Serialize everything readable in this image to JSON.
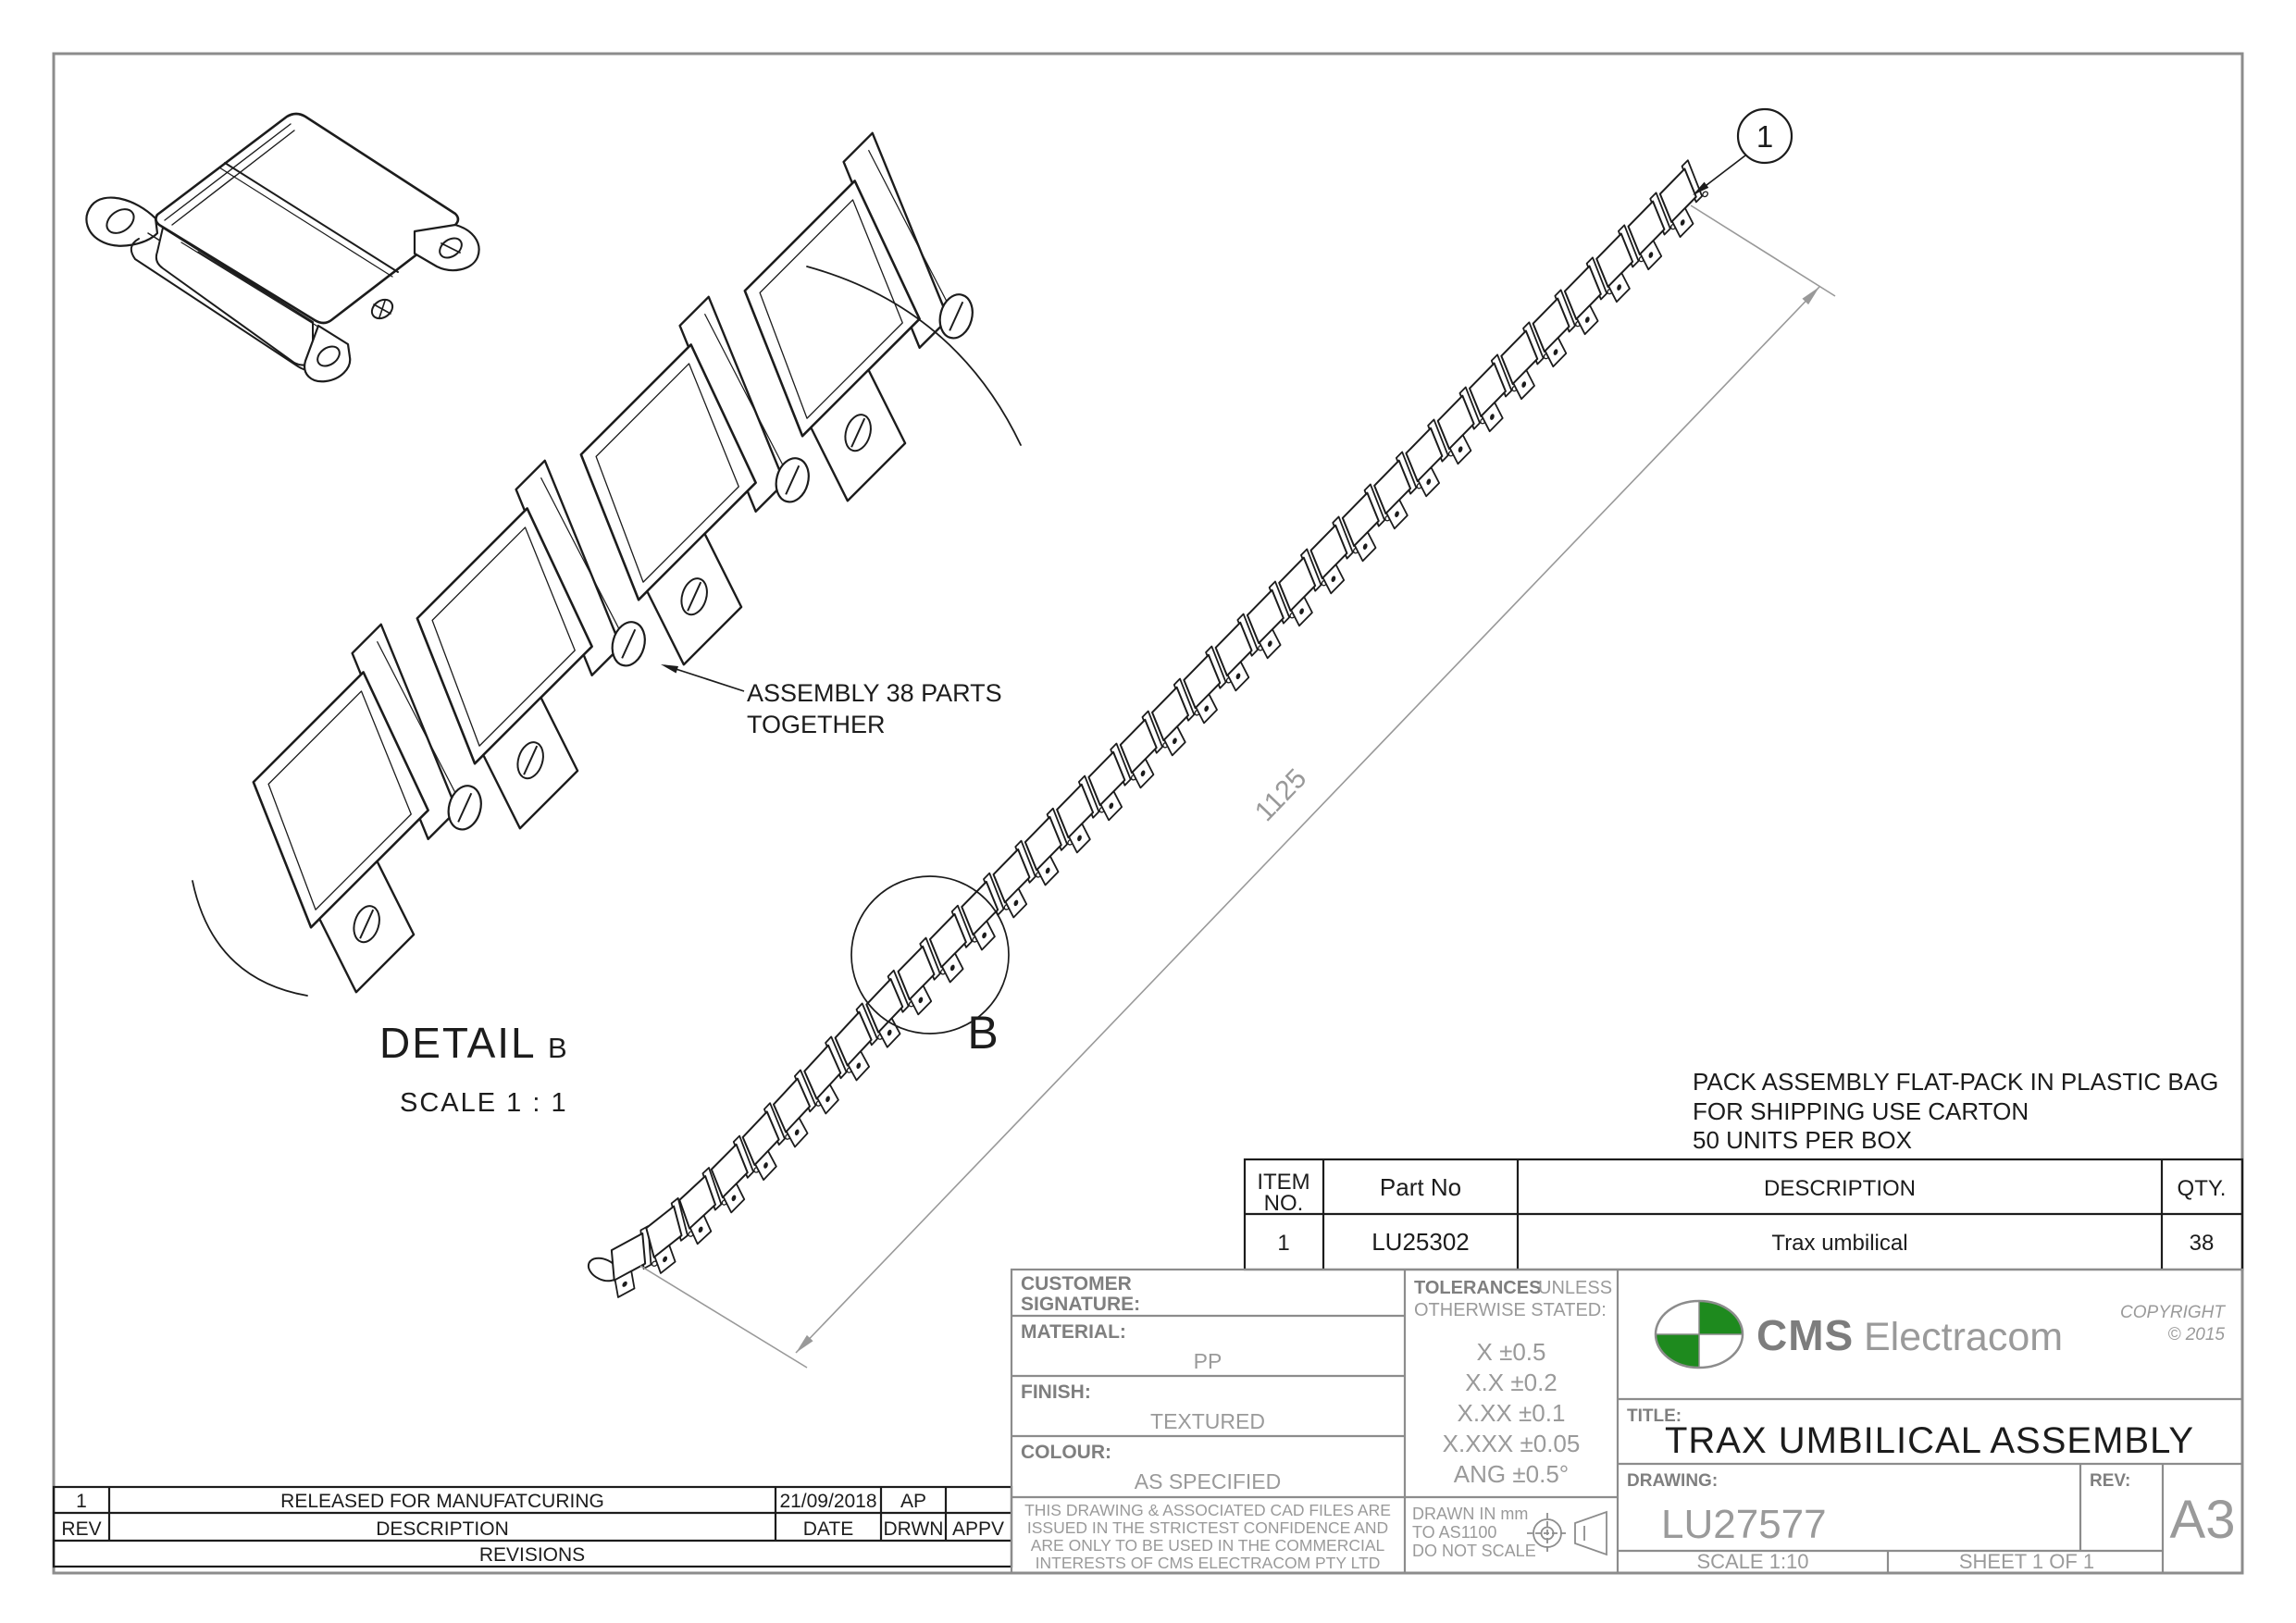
{
  "colors": {
    "line_black": "#1c1c1c",
    "line_gray": "#8c8c8c",
    "label_gray": "#7f7f7f",
    "value_gray": "#9a9a9a",
    "brand_green": "#1e8a1e"
  },
  "annotations": {
    "balloon": "1",
    "dimension": "1125",
    "assembly_note_1": "ASSEMBLY 38 PARTS",
    "assembly_note_2": "TOGETHER",
    "pack_note_1": "PACK ASSEMBLY FLAT-PACK IN PLASTIC BAG",
    "pack_note_2": "FOR SHIPPING USE  CARTON",
    "pack_note_3": "50 UNITS PER BOX",
    "detail_word": "DETAIL",
    "detail_letter": "B",
    "detail_scale": "SCALE  1 : 1",
    "detail_marker": "B"
  },
  "bom": {
    "headers": {
      "item_1": "ITEM",
      "item_2": "NO.",
      "part": "Part No",
      "description": "DESCRIPTION",
      "qty": "QTY."
    },
    "row": {
      "item": "1",
      "part": "LU25302",
      "description": "Trax umbilical",
      "qty": "38"
    }
  },
  "revisions": {
    "title": "REVISIONS",
    "headers": {
      "rev": "REV",
      "description": "DESCRIPTION",
      "date": "DATE",
      "drwn": "DRWN",
      "appv": "APPV"
    },
    "row": {
      "rev": "1",
      "description": "RELEASED FOR MANUFATCURING",
      "date": "21/09/2018",
      "drwn": "AP",
      "appv": ""
    }
  },
  "title_block": {
    "customer_label_1": "CUSTOMER",
    "customer_label_2": "SIGNATURE:",
    "material_label": "MATERIAL:",
    "material": "PP",
    "finish_label": "FINISH:",
    "finish": "TEXTURED",
    "colour_label": "COLOUR:",
    "colour": "AS SPECIFIED",
    "confidential_1": "THIS DRAWING & ASSOCIATED CAD FILES ARE",
    "confidential_2": "ISSUED IN THE STRICTEST CONFIDENCE AND",
    "confidential_3": "ARE ONLY TO BE USED IN THE COMMERCIAL",
    "confidential_4": "INTERESTS OF CMS ELECTRACOM PTY LTD",
    "tol_bold": "TOLERANCES",
    "tol_rest": "UNLESS",
    "tol_line2": "OTHERWISE STATED:",
    "tolerances": [
      "X  ±0.5",
      "X.X  ±0.2",
      "X.XX  ±0.1",
      "X.XXX  ±0.05",
      "ANG ±0.5°"
    ],
    "drawn_1": "DRAWN IN mm",
    "drawn_2": "TO AS1100",
    "drawn_3": "DO NOT SCALE",
    "brand": {
      "cms": "CMS",
      "name": "Electracom",
      "copyright": "COPYRIGHT",
      "year": "© 2015"
    },
    "title_label": "TITLE:",
    "title": "TRAX UMBILICAL ASSEMBLY",
    "drawing_label": "DRAWING:",
    "drawing_no": "LU27577",
    "rev_label": "REV:",
    "rev_value": "",
    "size": "A3",
    "scale": "SCALE 1:10",
    "sheet": "SHEET 1 OF 1"
  }
}
